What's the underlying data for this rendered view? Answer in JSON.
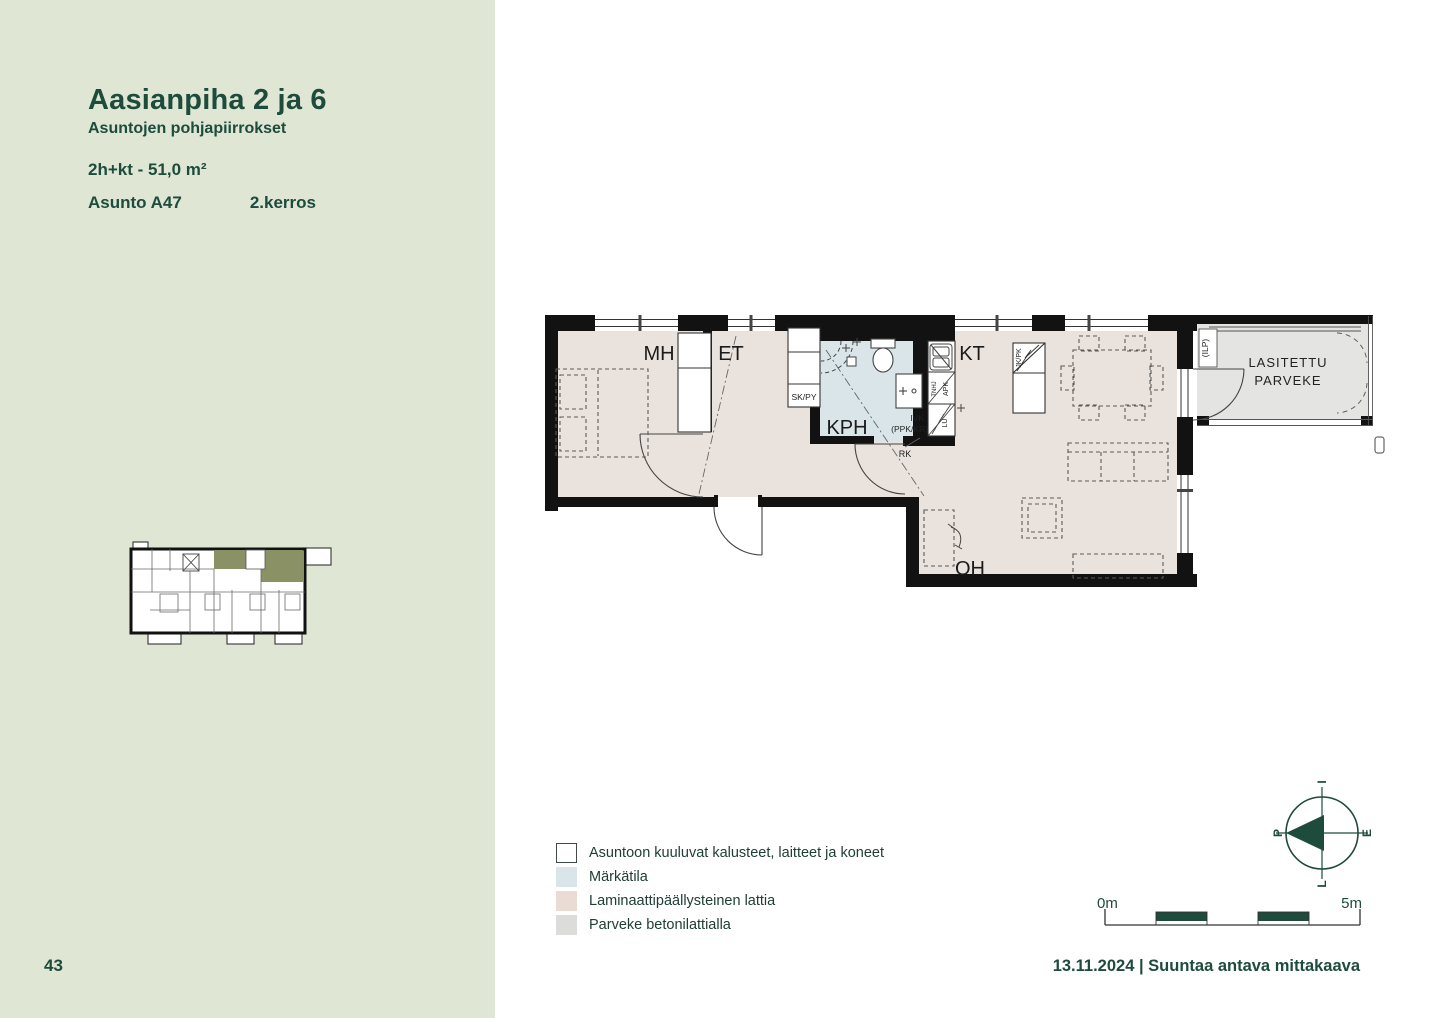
{
  "page": {
    "background": "#ffffff",
    "accent_color": "#1d4b3c"
  },
  "sidebar": {
    "background": "#dfe6d4",
    "title": "Aasianpiha 2 ja 6",
    "subtitle": "Asuntojen pohjapiirrokset",
    "unit_type": "2h+kt - 51,0 m²",
    "unit_name": "Asunto A47",
    "unit_floor": "2.kerros",
    "page_number": "43"
  },
  "plan": {
    "room_labels": {
      "bedroom": "MH",
      "entry": "ET",
      "bathroom": "KPH",
      "kitchen": "KT",
      "living": "OH"
    },
    "balcony_label": {
      "line1": "LASITETTU",
      "line2": "PARVEKE"
    },
    "fixture_labels": {
      "closet": "SK/PY",
      "vent_line1": "IVK",
      "vent_line2": "(PPK/KR)",
      "electric_panel": "RK",
      "counter": "TNHJ",
      "dishwasher": "APK",
      "stove": "LU",
      "fridge": "JK/PK",
      "heat_pump": "(ILP)"
    },
    "colors": {
      "wall": "#121212",
      "laminate_floor": "#eae3dd",
      "wet_room": "#d9e5e8",
      "balcony_floor": "#e4e4e2",
      "highlight_olive": "#8a9164"
    }
  },
  "legend": {
    "items": [
      {
        "label": "Asuntoon kuuluvat kalusteet, laitteet ja koneet",
        "swatch": "#ffffff",
        "bordered": true
      },
      {
        "label": "Märkätila",
        "swatch": "#d9e5e8",
        "bordered": false
      },
      {
        "label": "Laminaattipäällysteinen lattia",
        "swatch": "#eadcd5",
        "bordered": false
      },
      {
        "label": "Parveke betonilattialla",
        "swatch": "#dcdcda",
        "bordered": false
      }
    ]
  },
  "compass": {
    "top": "I",
    "right": "E",
    "bottom": "L",
    "left": "P"
  },
  "scalebar": {
    "start": "0m",
    "end": "5m"
  },
  "footer": {
    "date_note": "13.11.2024 | Suuntaa antava mittakaava"
  }
}
